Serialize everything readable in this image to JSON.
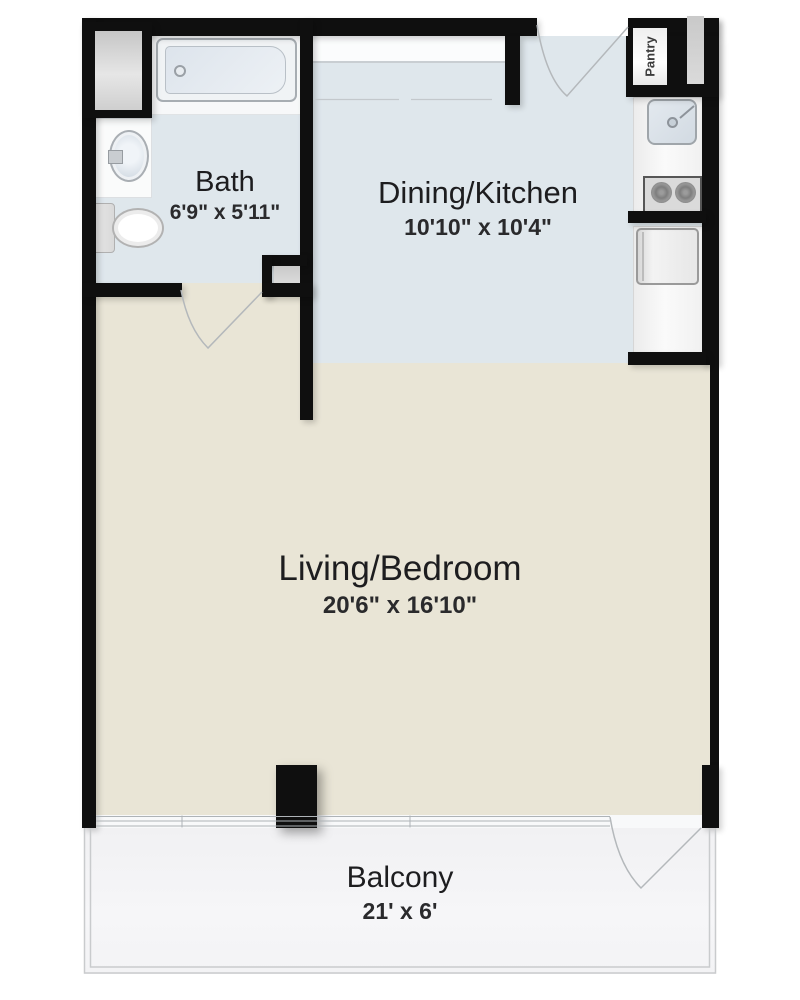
{
  "floorplan": {
    "rooms": {
      "bath": {
        "name": "Bath",
        "dims": "6'9\" x 5'11\""
      },
      "dining_kitchen": {
        "name": "Dining/Kitchen",
        "dims": "10'10\" x 10'4\""
      },
      "living_bedroom": {
        "name": "Living/Bedroom",
        "dims": "20'6\" x 16'10\""
      },
      "balcony": {
        "name": "Balcony",
        "dims": "21' x 6'"
      },
      "pantry": {
        "name": "Pantry"
      }
    },
    "colors": {
      "wall": "#0f0f0f",
      "bath_floor": "#dfe7ec",
      "kitchen_floor": "#dfe7ec",
      "living_floor": "#e9e5d6",
      "balcony_floor": "#f4f4f6",
      "door_swing_line": "#b4b8bb"
    },
    "fixtures": {
      "bath": [
        "bathtub",
        "oval-sink",
        "toilet",
        "linen-closet"
      ],
      "kitchen": [
        "kitchen-sink",
        "stove-two-burner",
        "refrigerator",
        "counter",
        "pantry-closet"
      ]
    }
  }
}
